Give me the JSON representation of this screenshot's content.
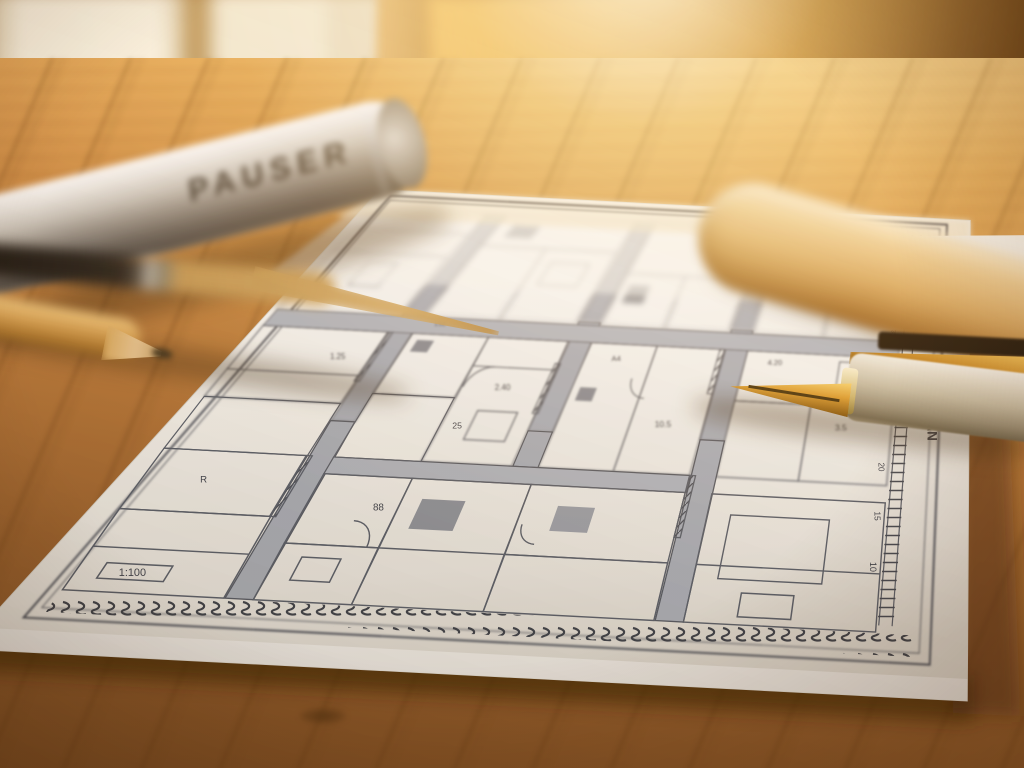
{
  "scene": {
    "description": "Architectural floor plan drawing on white paper lying on a warm sunlit wooden table, photographed at a shallow angle with blurred foreground and background",
    "objects": [
      "window",
      "wooden-table",
      "blueprint-sheet",
      "silver-document-tube",
      "beige-wooden-tube",
      "fountain-pen",
      "gold-pencil",
      "dark-brush-pencil",
      "second-paper-sheet"
    ]
  },
  "tube": {
    "label": "PAUSER"
  },
  "blueprint": {
    "ruler_label": "DU PLAN",
    "ruler_marks": [
      "45",
      "40",
      "35",
      "30",
      "25",
      "20",
      "15",
      "10"
    ],
    "scale_label": "1:100",
    "annotations": [
      "152",
      "2.40",
      "25",
      "A4",
      "10.5",
      "3.5",
      "1.25",
      "88",
      "4.20",
      "R"
    ]
  },
  "colors": {
    "paper": "#f5f4ef",
    "plan_line": "#5a616c",
    "wall_fill": "#a9afb8",
    "wood_light": "#f2c57e",
    "wood_dark": "#7f4f24",
    "sun_glow": "#ffd682",
    "silver_tube": "#c9c4ba",
    "beige_tube": "#d9ab69",
    "pen_gold": "#d99a33"
  },
  "plan": {
    "uw": 1380,
    "vh": 860,
    "shapes": [
      {
        "k": "q",
        "b": [
          -20,
          845,
          1415,
          952
        ],
        "f": "#3a2309",
        "o": 0.65,
        "s": "none",
        "g": "sh"
      },
      {
        "k": "q",
        "b": [
          1385,
          140,
          1480,
          900
        ],
        "f": "#4a2c10",
        "o": 0.5,
        "s": "none",
        "g": "sh"
      },
      {
        "k": "q",
        "b": [
          -25,
          -22,
          1405,
          882
        ],
        "f": "url(#paperGrad)",
        "s": "#d8d5cb",
        "w": 1,
        "g": "p"
      },
      {
        "k": "q",
        "b": [
          30,
          26,
          1350,
          832
        ],
        "s": "#4a505a",
        "w": 2.2,
        "g": "m"
      },
      {
        "k": "q",
        "b": [
          46,
          42,
          1334,
          816
        ],
        "s": "#4a505a",
        "w": 1,
        "g": "m"
      },
      {
        "k": "q",
        "b": [
          56,
          790,
          1324,
          822
        ],
        "f": "url(#stamp)",
        "s": "none",
        "g": "n"
      },
      {
        "k": "l",
        "p": [
          1272,
          66,
          1272,
          778
        ],
        "w": 1.4,
        "g": "n"
      },
      {
        "k": "l",
        "p": [
          1292,
          66,
          1292,
          778
        ],
        "w": 1.4,
        "g": "n"
      },
      {
        "k": "q",
        "b": [
          1270,
          72,
          1294,
          772
        ],
        "f": "url(#rungs)",
        "s": "none",
        "g": "n"
      },
      {
        "k": "t",
        "p": [
          1252,
          130
        ],
        "x": "45",
        "fs": 8,
        "rot": 90,
        "g": "n"
      },
      {
        "k": "t",
        "p": [
          1252,
          210
        ],
        "x": "40",
        "fs": 8,
        "rot": 90,
        "g": "n"
      },
      {
        "k": "t",
        "p": [
          1252,
          290
        ],
        "x": "35",
        "fs": 8,
        "rot": 90,
        "g": "n"
      },
      {
        "k": "t",
        "p": [
          1252,
          370
        ],
        "x": "30",
        "fs": 8,
        "rot": 90,
        "g": "n"
      },
      {
        "k": "t",
        "p": [
          1252,
          450
        ],
        "x": "25",
        "fs": 8,
        "rot": 90,
        "g": "n"
      },
      {
        "k": "t",
        "p": [
          1252,
          530
        ],
        "x": "20",
        "fs": 8,
        "rot": 90,
        "g": "n"
      },
      {
        "k": "t",
        "p": [
          1252,
          610
        ],
        "x": "15",
        "fs": 8,
        "rot": 90,
        "g": "n"
      },
      {
        "k": "t",
        "p": [
          1252,
          690
        ],
        "x": "10",
        "fs": 8,
        "rot": 90,
        "g": "n"
      },
      {
        "k": "t",
        "p": [
          1330,
          430
        ],
        "x": "DU PLAN",
        "fs": 15,
        "rot": 90,
        "fw": 700,
        "g": "n"
      },
      {
        "k": "q",
        "b": [
          300,
          70,
          342,
          300
        ],
        "f": "#a9afb8",
        "s": "#565c66",
        "w": 1.2
      },
      {
        "k": "q",
        "b": [
          300,
          300,
          342,
          500
        ],
        "f": "#a9afb8",
        "s": "#565c66",
        "w": 1.2
      },
      {
        "k": "q",
        "b": [
          300,
          500,
          342,
          788
        ],
        "f": "#a9afb8",
        "s": "#565c66",
        "w": 1.2
      },
      {
        "k": "q",
        "b": [
          642,
          70,
          684,
          300
        ],
        "f": "#a9afb8",
        "s": "#565c66",
        "w": 1.2
      },
      {
        "k": "q",
        "b": [
          642,
          300,
          684,
          500
        ],
        "f": "#a9afb8",
        "s": "#565c66",
        "w": 1.2
      },
      {
        "k": "q",
        "b": [
          642,
          500,
          684,
          560
        ],
        "f": "#a9afb8",
        "s": "#565c66",
        "w": 1.2
      },
      {
        "k": "q",
        "b": [
          940,
          70,
          982,
          300
        ],
        "f": "#a9afb8",
        "s": "#565c66",
        "w": 1.2
      },
      {
        "k": "q",
        "b": [
          940,
          300,
          982,
          500
        ],
        "f": "#a9afb8",
        "s": "#565c66",
        "w": 1.2
      },
      {
        "k": "q",
        "b": [
          940,
          500,
          982,
          788
        ],
        "f": "#a9afb8",
        "s": "#565c66",
        "w": 1.2
      },
      {
        "k": "q",
        "b": [
          58,
          306,
          1270,
          338
        ],
        "f": "#b0b6be",
        "s": "#565c66",
        "w": 1.2
      },
      {
        "k": "q",
        "b": [
          342,
          560,
          940,
          588
        ],
        "f": "#b0b6be",
        "s": "#565c66",
        "w": 1.2
      },
      {
        "k": "q",
        "b": [
          58,
          70,
          298,
          180
        ]
      },
      {
        "k": "q",
        "b": [
          58,
          180,
          298,
          306
        ]
      },
      {
        "k": "q",
        "b": [
          342,
          70,
          640,
          150
        ]
      },
      {
        "k": "q",
        "b": [
          342,
          150,
          488,
          306
        ]
      },
      {
        "k": "q",
        "b": [
          488,
          150,
          640,
          306
        ]
      },
      {
        "k": "q",
        "b": [
          684,
          70,
          938,
          196
        ]
      },
      {
        "k": "q",
        "b": [
          684,
          196,
          810,
          306
        ]
      },
      {
        "k": "q",
        "b": [
          810,
          196,
          938,
          306
        ]
      },
      {
        "k": "q",
        "b": [
          982,
          70,
          1268,
          188
        ]
      },
      {
        "k": "q",
        "b": [
          982,
          188,
          1120,
          306
        ]
      },
      {
        "k": "q",
        "b": [
          1120,
          188,
          1268,
          306
        ]
      },
      {
        "k": "q",
        "b": [
          380,
          96,
          440,
          128
        ],
        "f": "#8f959e",
        "s": "none"
      },
      {
        "k": "q",
        "b": [
          706,
          220,
          748,
          258
        ],
        "f": "#8f959e",
        "s": "none"
      },
      {
        "k": "q",
        "b": [
          1010,
          100,
          1060,
          132
        ]
      },
      {
        "k": "l",
        "p": [
          58,
          126,
          298,
          126
        ]
      },
      {
        "k": "l",
        "p": [
          982,
          130,
          1268,
          130
        ]
      },
      {
        "k": "q",
        "b": [
          150,
          200,
          210,
          250
        ]
      },
      {
        "k": "q",
        "b": [
          520,
          180,
          600,
          230
        ]
      },
      {
        "k": "q",
        "b": [
          58,
          338,
          298,
          470
        ]
      },
      {
        "k": "q",
        "b": [
          58,
          470,
          298,
          560
        ]
      },
      {
        "k": "q",
        "b": [
          342,
          338,
          488,
          450
        ]
      },
      {
        "k": "q",
        "b": [
          342,
          450,
          488,
          560
        ]
      },
      {
        "k": "q",
        "b": [
          488,
          338,
          640,
          560
        ]
      },
      {
        "k": "q",
        "b": [
          684,
          338,
          810,
          560
        ]
      },
      {
        "k": "q",
        "b": [
          810,
          338,
          938,
          560
        ]
      },
      {
        "k": "q",
        "b": [
          982,
          338,
          1268,
          430
        ]
      },
      {
        "k": "q",
        "b": [
          982,
          430,
          1120,
          560
        ]
      },
      {
        "k": "q",
        "b": [
          1120,
          430,
          1268,
          560
        ]
      },
      {
        "k": "q",
        "b": [
          360,
          350,
          392,
          372
        ],
        "f": "#858b95",
        "s": "none"
      },
      {
        "k": "l",
        "p": [
          488,
          392,
          640,
          392
        ]
      },
      {
        "k": "q",
        "b": [
          700,
          420,
          730,
          444
        ],
        "f": "#858b95",
        "s": "none"
      },
      {
        "k": "q",
        "b": [
          296,
          338,
          306,
          430
        ],
        "f": "url(#hatch)"
      },
      {
        "k": "q",
        "b": [
          636,
          380,
          646,
          470
        ],
        "f": "url(#hatch)"
      },
      {
        "k": "q",
        "b": [
          930,
          338,
          940,
          420
        ],
        "f": "url(#hatch)"
      },
      {
        "k": "a",
        "c": [
          530,
          430
        ],
        "r": 38,
        "a0": 180,
        "a1": 270
      },
      {
        "k": "a",
        "c": [
          820,
          400
        ],
        "r": 34,
        "a0": 90,
        "a1": 180
      },
      {
        "k": "q",
        "b": [
          540,
          470,
          610,
          520
        ]
      },
      {
        "k": "l",
        "p": [
          58,
          420,
          298,
          420
        ]
      },
      {
        "k": "q",
        "b": [
          1160,
          350,
          1240,
          400
        ]
      },
      {
        "k": "q",
        "b": [
          58,
          560,
          298,
          660
        ]
      },
      {
        "k": "q",
        "b": [
          58,
          660,
          298,
          788
        ]
      },
      {
        "k": "q",
        "b": [
          342,
          588,
          488,
          700
        ]
      },
      {
        "k": "q",
        "b": [
          342,
          700,
          488,
          788
        ]
      },
      {
        "k": "q",
        "b": [
          488,
          588,
          684,
          788
        ]
      },
      {
        "k": "l",
        "p": [
          488,
          700,
          684,
          700
        ]
      },
      {
        "k": "q",
        "b": [
          684,
          588,
          938,
          700
        ]
      },
      {
        "k": "q",
        "b": [
          684,
          700,
          938,
          788
        ]
      },
      {
        "k": "q",
        "b": [
          982,
          588,
          1268,
          788
        ]
      },
      {
        "k": "q",
        "b": [
          1020,
          620,
          1180,
          720
        ]
      },
      {
        "k": "l",
        "p": [
          982,
          700,
          1268,
          700
        ]
      },
      {
        "k": "q",
        "b": [
          520,
          620,
          590,
          668
        ],
        "f": "#8d939c",
        "s": "none"
      },
      {
        "k": "q",
        "b": [
          938,
          560,
          948,
          660
        ],
        "f": "url(#hatch)"
      },
      {
        "k": "q",
        "b": [
          296,
          560,
          306,
          660
        ],
        "f": "url(#hatch)"
      },
      {
        "k": "a",
        "c": [
          430,
          700
        ],
        "r": 40,
        "a0": -90,
        "a1": 0
      },
      {
        "k": "q",
        "b": [
          380,
          720,
          440,
          756
        ]
      },
      {
        "k": "q",
        "b": [
          740,
          620,
          800,
          660
        ],
        "f": "#9aa0a9",
        "s": "none"
      },
      {
        "k": "l",
        "p": [
          58,
          720,
          298,
          720
        ]
      },
      {
        "k": "q",
        "b": [
          1060,
          740,
          1140,
          776
        ]
      },
      {
        "k": "a",
        "c": [
          724,
          652
        ],
        "r": 30,
        "a0": 90,
        "a1": 180
      },
      {
        "k": "q",
        "b": [
          96,
          744,
          196,
          768
        ],
        "g": "n"
      },
      {
        "k": "t",
        "p": [
          146,
          762
        ],
        "x": "1:100",
        "fs": 9,
        "g": "n"
      },
      {
        "k": "t",
        "p": [
          385,
          322
        ],
        "x": "152",
        "fs": 9
      },
      {
        "k": "t",
        "p": [
          565,
          432
        ],
        "x": "2.40",
        "fs": 9
      },
      {
        "k": "t",
        "p": [
          520,
          502
        ],
        "x": "25",
        "fs": 9
      },
      {
        "k": "t",
        "p": [
          745,
          370
        ],
        "x": "A4",
        "fs": 9
      },
      {
        "k": "t",
        "p": [
          870,
          482
        ],
        "x": "10.5",
        "fs": 9
      },
      {
        "k": "t",
        "p": [
          1180,
          472
        ],
        "x": "3.5",
        "fs": 9
      },
      {
        "k": "t",
        "p": [
          240,
          392
        ],
        "x": "1.25",
        "fs": 9
      },
      {
        "k": "t",
        "p": [
          460,
          642
        ],
        "x": "88",
        "fs": 9
      },
      {
        "k": "t",
        "p": [
          1040,
          362
        ],
        "x": "4.20",
        "fs": 9
      },
      {
        "k": "t",
        "p": [
          160,
          612
        ],
        "x": "R",
        "fs": 9
      },
      {
        "k": "q",
        "b": [
          -25,
          -22,
          1405,
          240
        ],
        "f": "rgba(247,245,238,0.55)",
        "s": "none",
        "g": "f"
      },
      {
        "k": "q",
        "b": [
          -25,
          -22,
          1405,
          95
        ],
        "f": "rgba(244,228,198,0.6)",
        "s": "none",
        "g": "f"
      },
      {
        "k": "q",
        "b": [
          -25,
          850,
          1405,
          882
        ],
        "f": "rgba(255,255,255,0.45)",
        "s": "none",
        "g": "n"
      }
    ]
  }
}
